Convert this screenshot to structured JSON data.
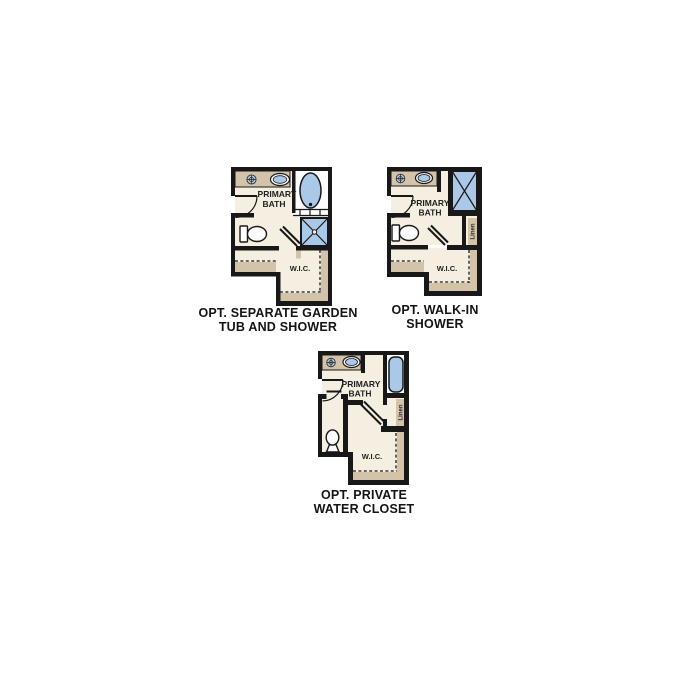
{
  "page": {
    "background": "#ffffff"
  },
  "colors": {
    "wall": "#181818",
    "floor": "#f4efe1",
    "counter_tan": "#d3c4a9",
    "fixture_blue": "#aac9e8",
    "fixture_white": "#fdfdfd",
    "text": "#141414"
  },
  "plans": [
    {
      "id": "separate-garden-tub-and-shower",
      "caption": {
        "line1": "OPT. SEPARATE GARDEN",
        "line2": "TUB AND SHOWER"
      },
      "labels": {
        "room_line1": "PRIMARY",
        "room_line2": "BATH",
        "closet": "W.I.C."
      },
      "fixtures": [
        "vanity-counter",
        "faucet-icon",
        "sink-icon",
        "garden-tub-icon",
        "shower-icon",
        "toilet-icon",
        "entry-door",
        "closet-door",
        "closet-shelves"
      ]
    },
    {
      "id": "walk-in-shower",
      "caption": {
        "line1": "OPT. WALK-IN",
        "line2": "SHOWER"
      },
      "labels": {
        "room_line1": "PRIMARY",
        "room_line2": "BATH",
        "closet": "W.I.C.",
        "linen": "Linen"
      },
      "fixtures": [
        "vanity-counter",
        "faucet-icon",
        "sink-icon",
        "walk-in-shower-icon",
        "toilet-icon",
        "linen-closet",
        "entry-door",
        "closet-door",
        "closet-shelves"
      ]
    },
    {
      "id": "private-water-closet",
      "caption": {
        "line1": "OPT. PRIVATE",
        "line2": "WATER CLOSET"
      },
      "labels": {
        "room_line1": "PRIMARY",
        "room_line2": "BATH",
        "closet": "W.I.C.",
        "linen": "Linen"
      },
      "fixtures": [
        "vanity-counter",
        "faucet-icon",
        "sink-icon",
        "soaking-tub-icon",
        "toilet-icon",
        "linen-closet",
        "water-closet-room",
        "entry-door",
        "closet-door",
        "closet-shelves"
      ]
    }
  ]
}
